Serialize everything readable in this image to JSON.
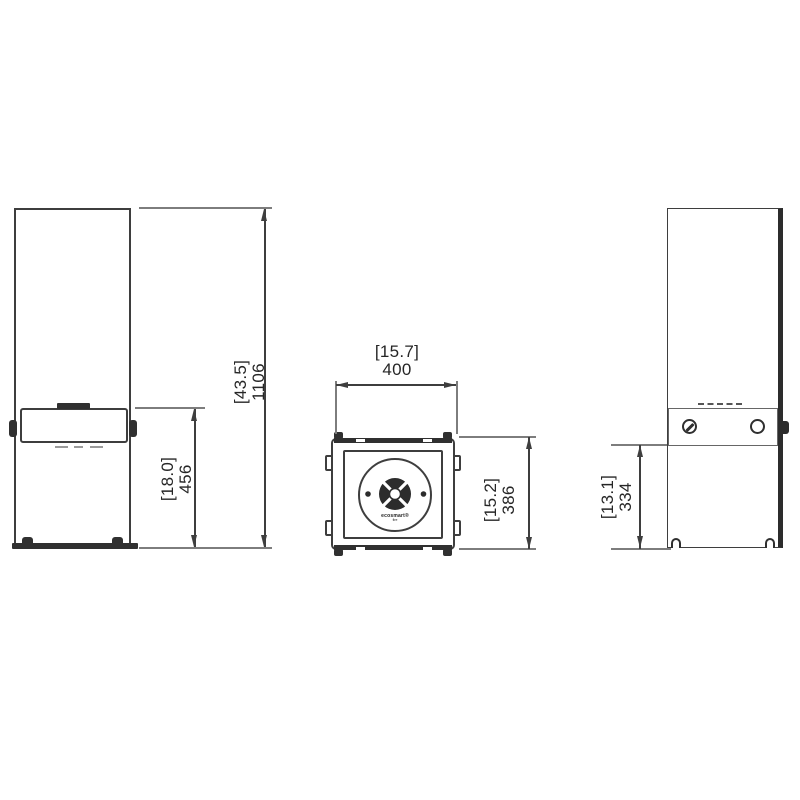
{
  "drawing": {
    "colors": {
      "outline": "#3e3e3e",
      "dark_fill": "#2c2c2c",
      "extension_line": "#7d7d7d",
      "text": "#262626",
      "background": "#ffffff"
    },
    "front_view": {
      "overall_height_in": "[43.5]",
      "overall_height_mm": "1106",
      "burner_height_in": "[18.0]",
      "burner_height_mm": "456"
    },
    "top_view": {
      "width_in": "[15.7]",
      "width_mm": "400",
      "depth_in": "[15.2]",
      "depth_mm": "386",
      "logo_line1": "ecosmart®",
      "logo_line2": "fire"
    },
    "side_view": {
      "panel_height_in": "[13.1]",
      "panel_height_mm": "334"
    }
  }
}
